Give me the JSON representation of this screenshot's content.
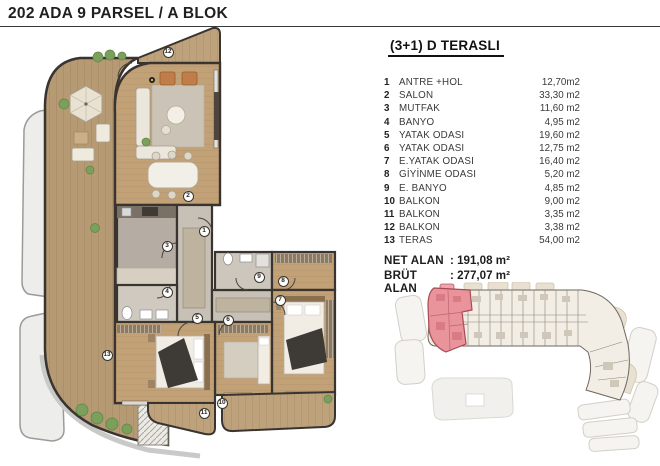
{
  "page": {
    "title": "202 ADA 9 PARSEL / A BLOK"
  },
  "unit_card": {
    "heading": "(3+1) D TERASLI",
    "rooms": [
      {
        "no": "1",
        "name": "ANTRE +HOL",
        "area": "12,70m2"
      },
      {
        "no": "2",
        "name": "SALON",
        "area": "33,30 m2"
      },
      {
        "no": "3",
        "name": "MUTFAK",
        "area": "11,60 m2"
      },
      {
        "no": "4",
        "name": "BANYO",
        "area": "4,95 m2"
      },
      {
        "no": "5",
        "name": "YATAK ODASI",
        "area": "19,60 m2"
      },
      {
        "no": "6",
        "name": "YATAK ODASI",
        "area": "12,75 m2"
      },
      {
        "no": "7",
        "name": "E.YATAK ODASI",
        "area": "16,40 m2"
      },
      {
        "no": "8",
        "name": "GİYİNME ODASI",
        "area": "5,20 m2"
      },
      {
        "no": "9",
        "name": "E. BANYO",
        "area": "4,85 m2"
      },
      {
        "no": "10",
        "name": "BALKON",
        "area": "9,00 m2"
      },
      {
        "no": "11",
        "name": "BALKON",
        "area": "3,35 m2"
      },
      {
        "no": "12",
        "name": "BALKON",
        "area": "3,38 m2"
      },
      {
        "no": "13",
        "name": "TERAS",
        "area": "54,00 m2"
      }
    ],
    "summary": {
      "net": {
        "label": "NET ALAN",
        "value": ": 191,08 m²"
      },
      "brut": {
        "label": "BRÜT ALAN",
        "value": ": 277,07 m²"
      }
    }
  },
  "floor_plan": {
    "room_labels": [
      {
        "n": "1",
        "x": 204,
        "y": 231
      },
      {
        "n": "2",
        "x": 188,
        "y": 196
      },
      {
        "n": "3",
        "x": 167,
        "y": 246
      },
      {
        "n": "4",
        "x": 167,
        "y": 292
      },
      {
        "n": "5",
        "x": 197,
        "y": 318
      },
      {
        "n": "6",
        "x": 228,
        "y": 320
      },
      {
        "n": "7",
        "x": 280,
        "y": 300
      },
      {
        "n": "8",
        "x": 283,
        "y": 281
      },
      {
        "n": "9",
        "x": 259,
        "y": 277
      },
      {
        "n": "10",
        "x": 222,
        "y": 403
      },
      {
        "n": "11",
        "x": 204,
        "y": 413
      },
      {
        "n": "12",
        "x": 168,
        "y": 52
      },
      {
        "n": "13",
        "x": 107,
        "y": 355
      }
    ]
  },
  "key_plan": {
    "highlight_color": "#e9939b"
  },
  "colors": {
    "highlight_pink": "#e9939b",
    "highlight_pink_outline": "#a84a56",
    "wood_floor": "#c2a176",
    "terrace_deck": "#b59a74",
    "tile_gray": "#c6c0b7",
    "wall_dark": "#39342f",
    "greenery": "#7ba05b"
  }
}
